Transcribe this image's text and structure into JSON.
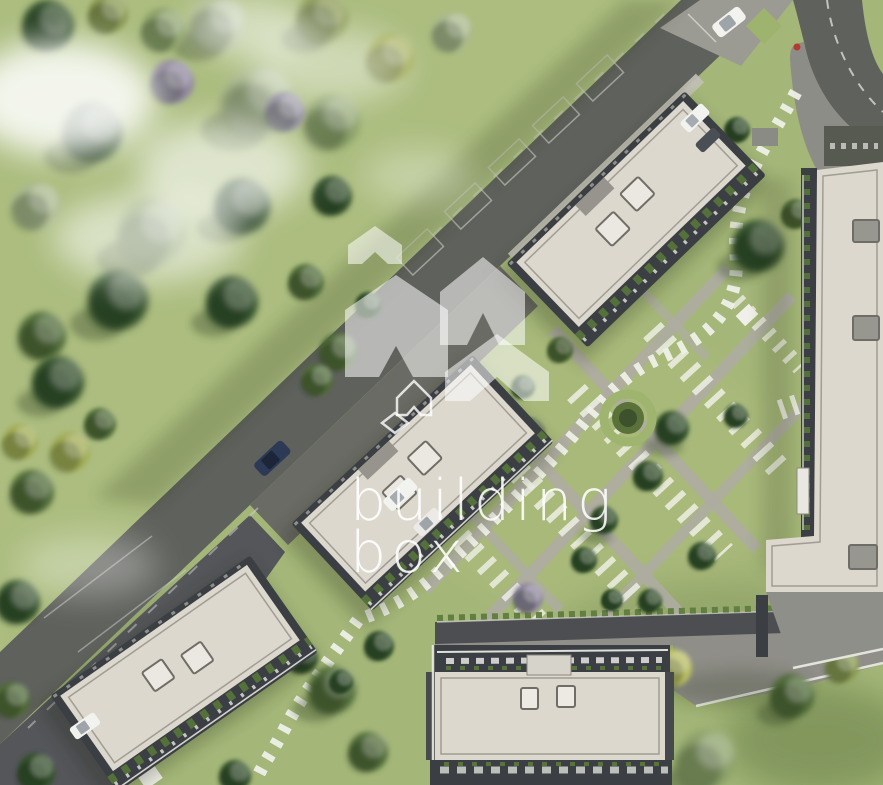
{
  "watermark": {
    "line1": "building",
    "line2": "box"
  },
  "palette": {
    "grass": "#a4b678",
    "park_grass": "#c9d49c",
    "road": "#5f615c",
    "pavement": "#9c9b93",
    "plaza": "#8f8e88",
    "roof": "#dcd8ce",
    "balcony_frame": "#3b3e42",
    "path": "#aeaca2",
    "stone_white": "#eff0e8",
    "tree_dark": "#33502c",
    "tree_light": "#8da26b",
    "hedge_green": "#9fb46e",
    "watermark_shape": "rgba(255,255,255,0.55)",
    "watermark_text": "rgba(255,255,255,0.88)",
    "car_white": "#f2f2ef",
    "car_navy": "#2c3a56",
    "pedestrian_red": "#b43a32"
  },
  "scene": {
    "type": "aerial-3d-site-plan-render",
    "buildings": [
      "top-block",
      "middle-block",
      "lower-left-block",
      "bottom-center-block",
      "right-block"
    ],
    "vehicles": [
      "white-car-top-right",
      "navy-car-road",
      "white-van-parking",
      "white-car-parking",
      "white-car-lot",
      "white-van-top",
      "dark-car-top"
    ],
    "landscape": [
      "park-trees",
      "lawn",
      "fog-patches",
      "stepping-stone-paths",
      "courtyard-garden",
      "circular-hedge",
      "bench-rows",
      "parking-bays"
    ]
  }
}
